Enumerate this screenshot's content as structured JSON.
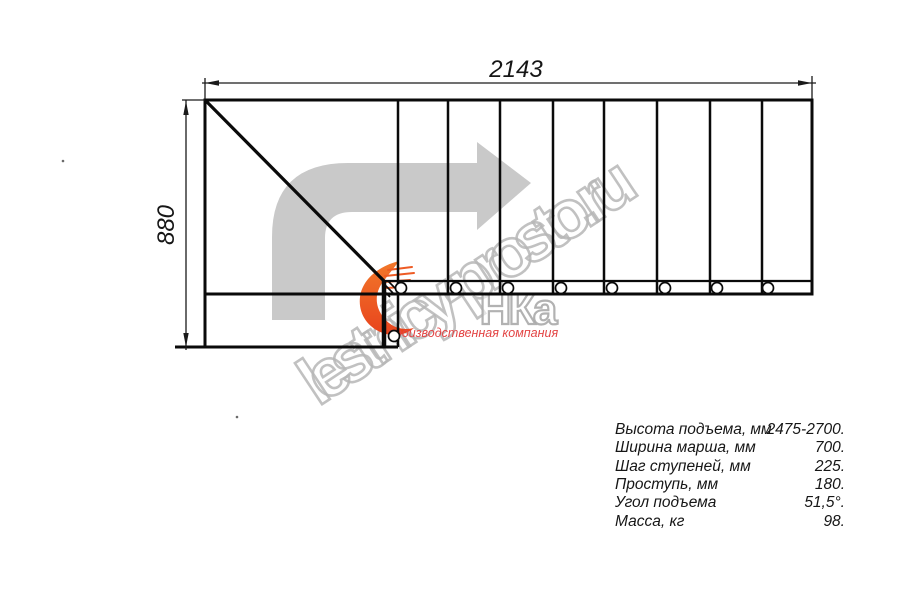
{
  "page": {
    "background": "#ffffff",
    "width": 900,
    "height": 600
  },
  "drawing": {
    "type": "staircase-plan-top-view",
    "flight_tread_lines": 8,
    "baluster_circles": 9,
    "direction_arrow": "up-then-right"
  },
  "dimensions": {
    "width_label": "2143",
    "height_label": "880"
  },
  "watermark": {
    "site_text": "lestnicy-prosto.ru",
    "logo_text": "НКа",
    "logo_tagline": "производственная компания"
  },
  "specs": {
    "rows": [
      {
        "label": "Высота подъема, мм",
        "value": "2475-2700."
      },
      {
        "label": "Ширина марша, мм",
        "value": "700."
      },
      {
        "label": "Шаг ступеней, мм",
        "value": "225."
      },
      {
        "label": "Проступь, мм",
        "value": "180."
      },
      {
        "label": "Угол подъема",
        "value": "51,5°."
      },
      {
        "label": "Масса, кг",
        "value": "98."
      }
    ]
  },
  "colors": {
    "line": "#0a0a0a",
    "arrow_gray": "#c9c9c9",
    "watermark_gray": "#b6b6b6",
    "flame_orange": "#f2782a",
    "flame_red": "#e8431d",
    "tagline_red": "#e34444",
    "text": "#161616"
  }
}
